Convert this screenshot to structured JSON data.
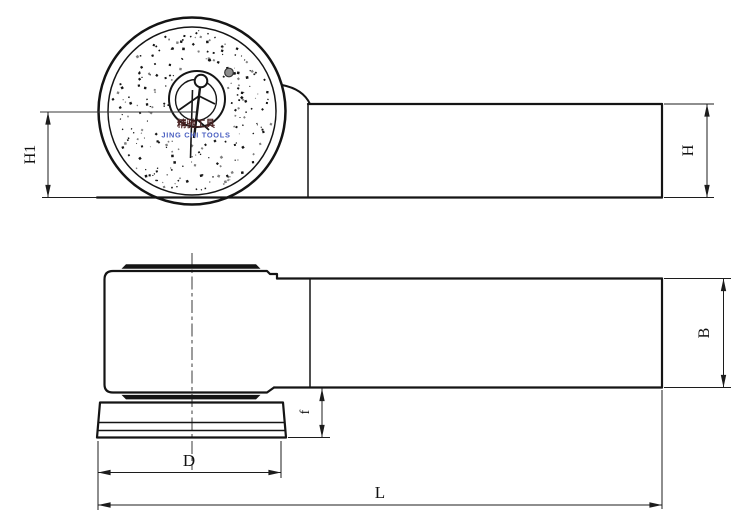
{
  "drawing": {
    "brand": {
      "chinese_text": "精驰工具",
      "english_text": "JING CHI TOOLS",
      "chinese_color": "#4a2323",
      "english_color": "#4a5fc1"
    },
    "dimensions": {
      "h1": "H1",
      "h": "H",
      "b": "B",
      "f": "f",
      "d": "D",
      "l": "L"
    },
    "colors": {
      "line": "#141414",
      "screw_dot": "#8e8e8e",
      "background": "#ffffff"
    }
  }
}
